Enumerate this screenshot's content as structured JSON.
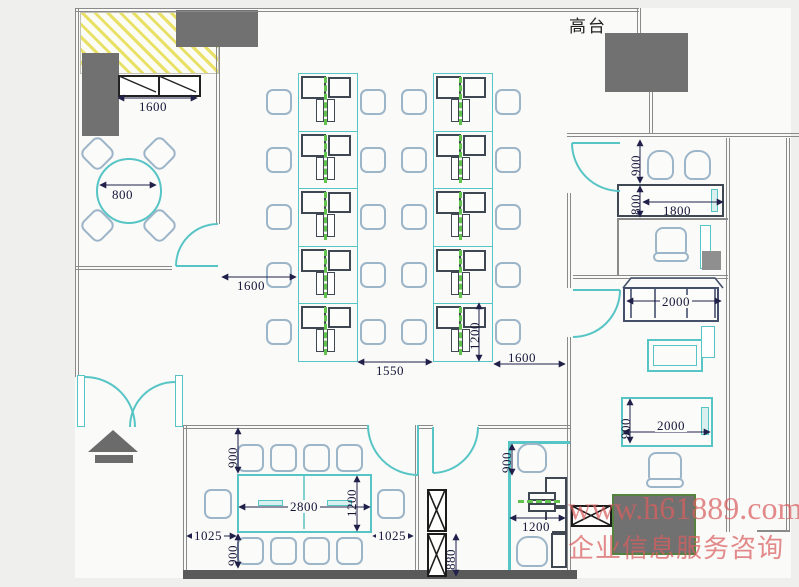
{
  "labels": {
    "platform": "高台"
  },
  "watermark": {
    "line1": "www.h61889.com",
    "line2": "企业信息服务咨询"
  },
  "colors": {
    "cyan": "#57c5c5",
    "wall": "#8a8a8a",
    "thick_wall": "#5a5a5a",
    "block": "#717171",
    "chair": "#9db5c8",
    "desk": "#3f4752",
    "green": "#62c24e",
    "dim_text": "#16163a",
    "hatch": "#e9e066",
    "watermark": "#d95f5f"
  },
  "workstation_area": {
    "columns": 2,
    "rows_per_column": 5,
    "desks_per_cluster": 2
  },
  "dims": {
    "storage_window": "1600",
    "round_table": "800",
    "meeting_room_door": "1600",
    "workstation_gap": "1550",
    "workstation_cluster_depth": "1200",
    "workstation_right": "1600",
    "office1_chairs": "900",
    "office1_desk_depth": "800",
    "office1_desk": "1800",
    "sofa": "2000",
    "exec_desk_depth": "900",
    "exec_desk": "2000",
    "conf_top_chairs": "900",
    "conf_bottom_chairs": "900",
    "conf_left": "1025",
    "conf_right": "1025",
    "conf_table": "2800",
    "conf_table_depth": "1200",
    "column": "880",
    "small_office_chairs": "900",
    "small_office_desk": "1200"
  }
}
